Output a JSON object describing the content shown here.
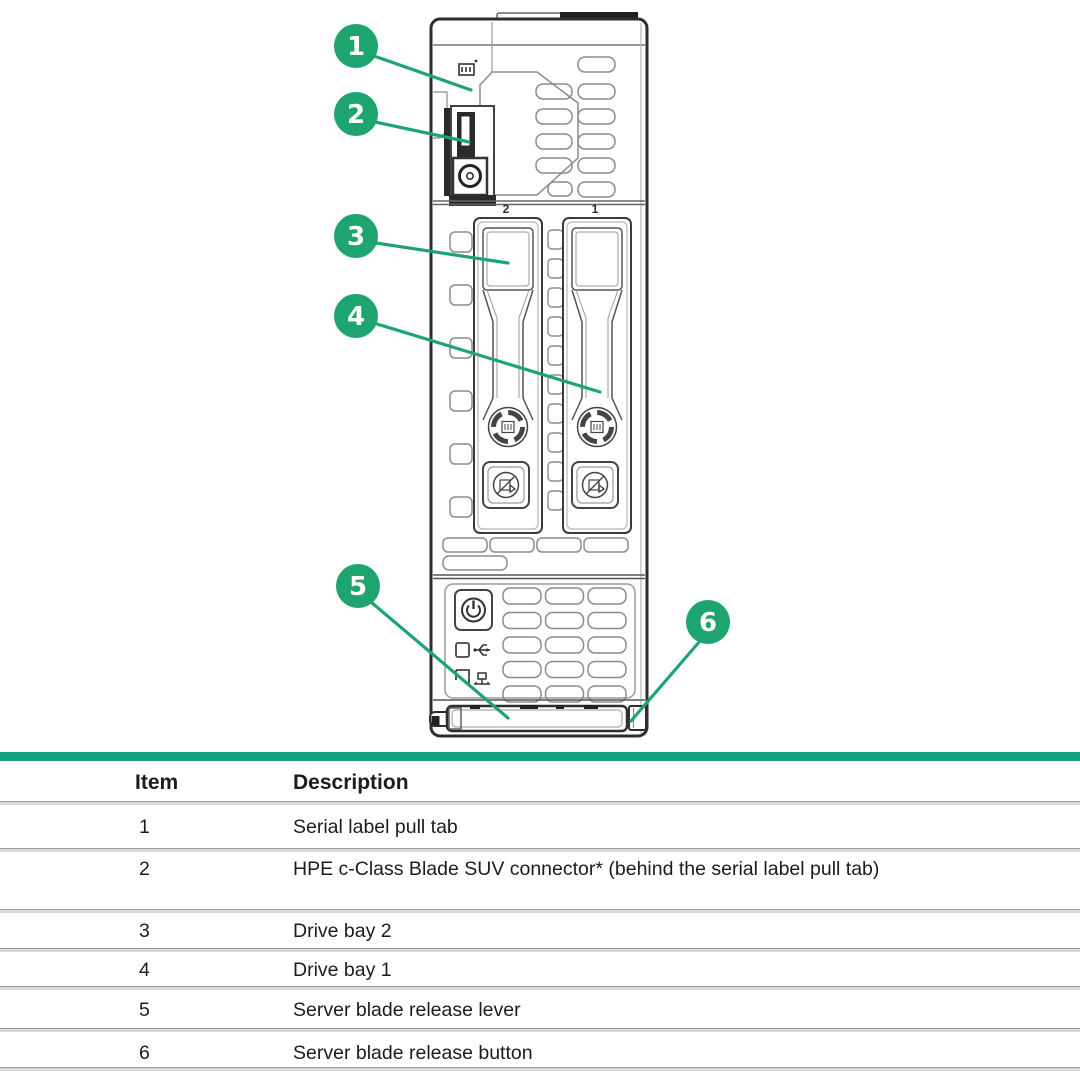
{
  "colors": {
    "callout_green": "#1EA46F",
    "accent_bar_green": "#0FA383",
    "drawing_line_dark": "#2E2E2E",
    "drawing_line_light": "#8C8C8C",
    "table_divider": "#D9D9D9",
    "table_divider_edge": "#9B9B9B",
    "text": "#1C1C1C"
  },
  "diagram": {
    "description": "Front view line drawing of HPE server blade with numbered callouts",
    "bay_labels": {
      "left": "2",
      "right": "1"
    },
    "callouts": [
      {
        "number": "1"
      },
      {
        "number": "2"
      },
      {
        "number": "3"
      },
      {
        "number": "4"
      },
      {
        "number": "5"
      },
      {
        "number": "6"
      }
    ],
    "icons": [
      "serial-label-icon",
      "suv-connector-icon",
      "power-icon",
      "usb-icon",
      "network-icon",
      "drive-latch-dial-icon",
      "drive-lock-icon"
    ]
  },
  "table": {
    "headers": {
      "item": "Item",
      "description": "Description"
    },
    "rows": [
      {
        "item": "1",
        "description": "Serial label pull tab"
      },
      {
        "item": "2",
        "description": "HPE c-Class Blade SUV connector* (behind the serial label pull tab)"
      },
      {
        "item": "3",
        "description": "Drive bay 2"
      },
      {
        "item": "4",
        "description": "Drive bay 1"
      },
      {
        "item": "5",
        "description": "Server blade release lever"
      },
      {
        "item": "6",
        "description": "Server blade release button"
      }
    ]
  }
}
